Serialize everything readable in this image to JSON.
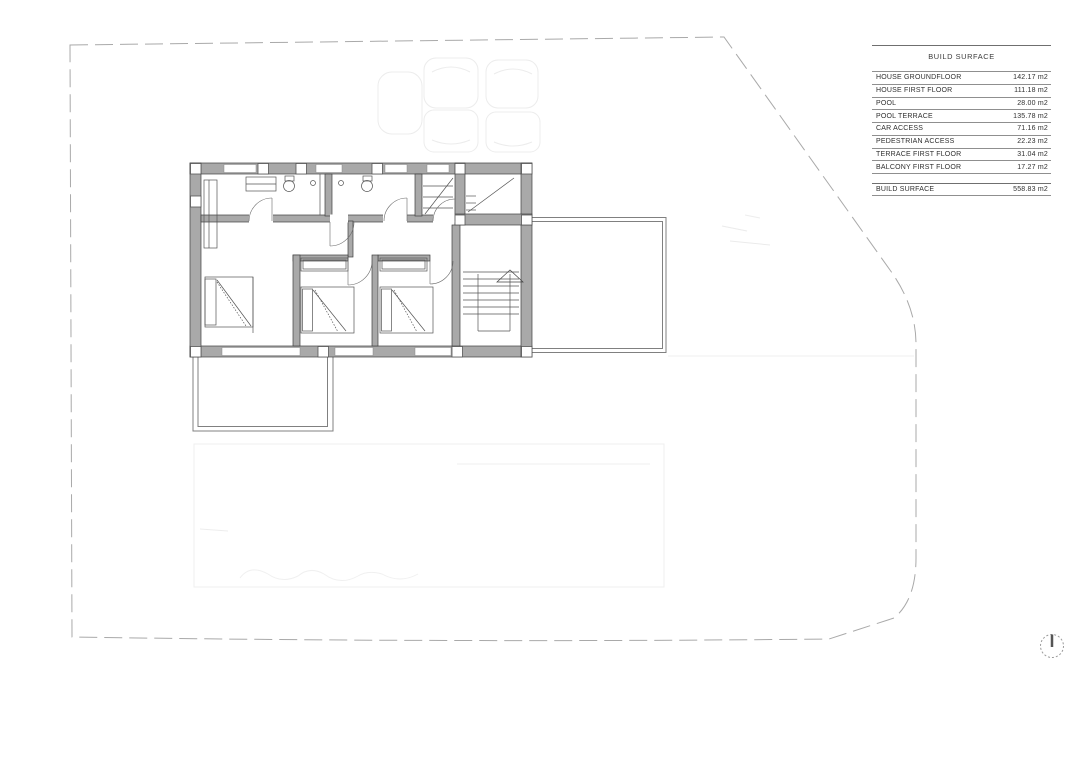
{
  "sheet": {
    "type": "architectural floor plan drawing, first floor",
    "background": "#ffffff"
  },
  "table": {
    "title": "BUILD SURFACE",
    "rows": [
      {
        "label": "HOUSE GROUNDFLOOR",
        "value": "142.17 m2"
      },
      {
        "label": "HOUSE FIRST FLOOR",
        "value": "111.18 m2"
      },
      {
        "label": "POOL",
        "value": "28.00 m2"
      },
      {
        "label": "POOL TERRACE",
        "value": "135.78 m2"
      },
      {
        "label": "CAR ACCESS",
        "value": "71.16 m2"
      },
      {
        "label": "PEDESTRIAN ACCESS",
        "value": "22.23 m2"
      },
      {
        "label": "TERRACE FIRST FLOOR",
        "value": "31.04 m2"
      },
      {
        "label": "BALCONY FIRST FLOOR",
        "value": "17.27 m2"
      }
    ],
    "total": {
      "label": "BUILD SURFACE",
      "value": "558.83 m2"
    }
  },
  "icons": {
    "north_indicator": "dotted-circle-with-north-needle"
  },
  "colors": {
    "wall_fill": "#a9a9a9",
    "wall_edge": "#3f3f3f",
    "thin_line": "#555555",
    "boundary_dash": "#a9a9a9",
    "faint_underlay": "#ececec",
    "table_rule": "#8f8f8f"
  }
}
